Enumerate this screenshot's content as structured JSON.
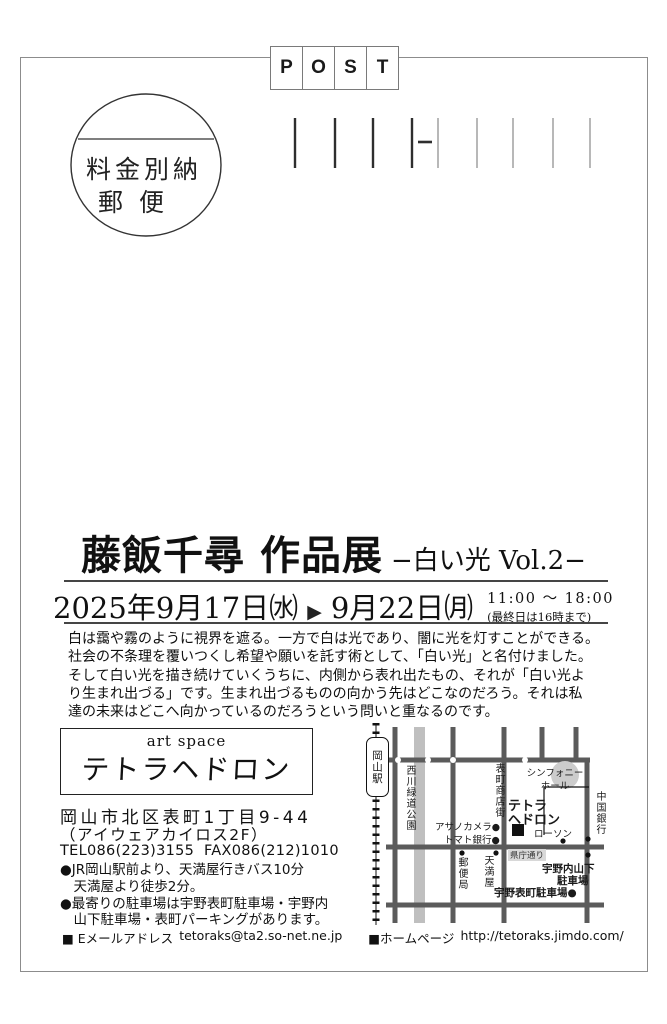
{
  "postmark": {
    "letters": [
      "P",
      "O",
      "S",
      "T"
    ],
    "stamp_line1": "料金別納",
    "stamp_line2": "郵便"
  },
  "title": {
    "main": "藤飯千尋 作品展",
    "sub": "−白い光 Vol.2−"
  },
  "schedule": {
    "start": "2025年9月17日㈬",
    "arrow": "▶",
    "end": "9月22日㈪",
    "time": "11:00 〜 18:00",
    "time_note": "(最終日は16時まで)"
  },
  "description": {
    "lines": [
      "白は靄や霧のように視界を遮る。一方で白は光であり、闇に光を灯すことができる。",
      "社会の不条理を覆いつくし希望や願いを託す術として、「白い光」と名付けました。",
      "そして白い光を描き続けていくうちに、内側から表れ出たもの、それが「白い光よ",
      "り生まれ出づる」です。生まれ出づるものの向かう先はどこなのだろう。それは私",
      "達の未来はどこへ向かっているのだろうという問いと重なるのです。"
    ]
  },
  "venue": {
    "logo_sub": "art space",
    "logo_name": "テトラヘドロン",
    "address_line1": "岡山市北区表町1丁目9-44",
    "address_line2": "（アイウェアカイロス2F）",
    "tel_fax": "TEL086(223)3155  FAX086(212)1010",
    "access_lines": [
      "●JR岡山駅前より、天満屋行きバス10分",
      "　天満屋より徒歩2分。",
      "●最寄りの駐車場は宇野表町駐車場・宇野内",
      "　山下駐車場・表町パーキングがあります。"
    ],
    "email_label": "■ Eメールアドレス",
    "email": "tetoraks@ta2.so-net.ne.jp",
    "homepage_label": "■ホームページ",
    "homepage": "http://tetoraks.jimdo.com/"
  },
  "map": {
    "station": "岡山駅",
    "park": "西川緑道公園",
    "shopping_street": "表町商店街",
    "symphony_hall_line1": "シンフォニー",
    "symphony_hall_line2": "ホール",
    "venue_line1": "テトラ",
    "venue_line2": "ヘドロン",
    "asano_camera": "アサノカメラ●",
    "tomato_bank": "トマト銀行●",
    "lawson": "ローソン",
    "chugoku_bank": "中国銀行",
    "post_office": "郵便局",
    "tenmaya": "天満屋",
    "kencho_street": "県庁通り",
    "uno_uchisange_line1": "宇野内山下",
    "uno_uchisange_line2": "駐車場",
    "uno_omotecho": "宇野表町駐車場●"
  }
}
